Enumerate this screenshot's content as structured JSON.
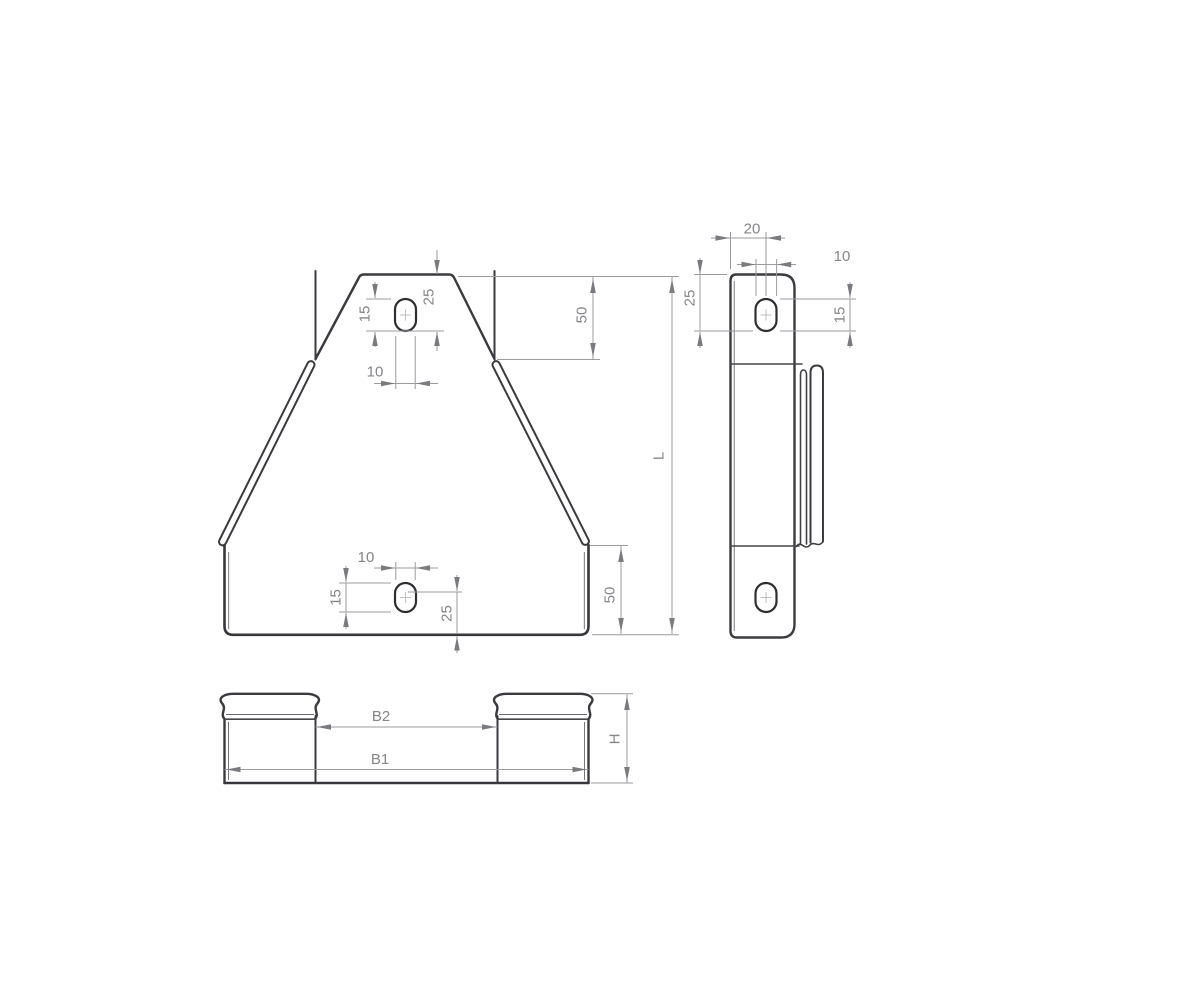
{
  "drawing": {
    "colors": {
      "background": "#ffffff",
      "part_outline": "#3b3b3f",
      "dimension_lines": "#9b9ba0",
      "dimension_text": "#85858a"
    },
    "front_view": {
      "hole_top": {
        "offset": "25",
        "length": "15",
        "width": "10"
      },
      "hole_bottom": {
        "width": "10",
        "length": "15",
        "offset": "25"
      },
      "top_end_depth": "50",
      "bottom_end_depth": "50",
      "overall_length": "L"
    },
    "side_view": {
      "hole_center_from_edge": "20",
      "hole_width": "10",
      "hole_offset": "25",
      "hole_length": "15"
    },
    "bottom_view": {
      "inner_width": "B2",
      "outer_width": "B1",
      "height": "H"
    }
  }
}
